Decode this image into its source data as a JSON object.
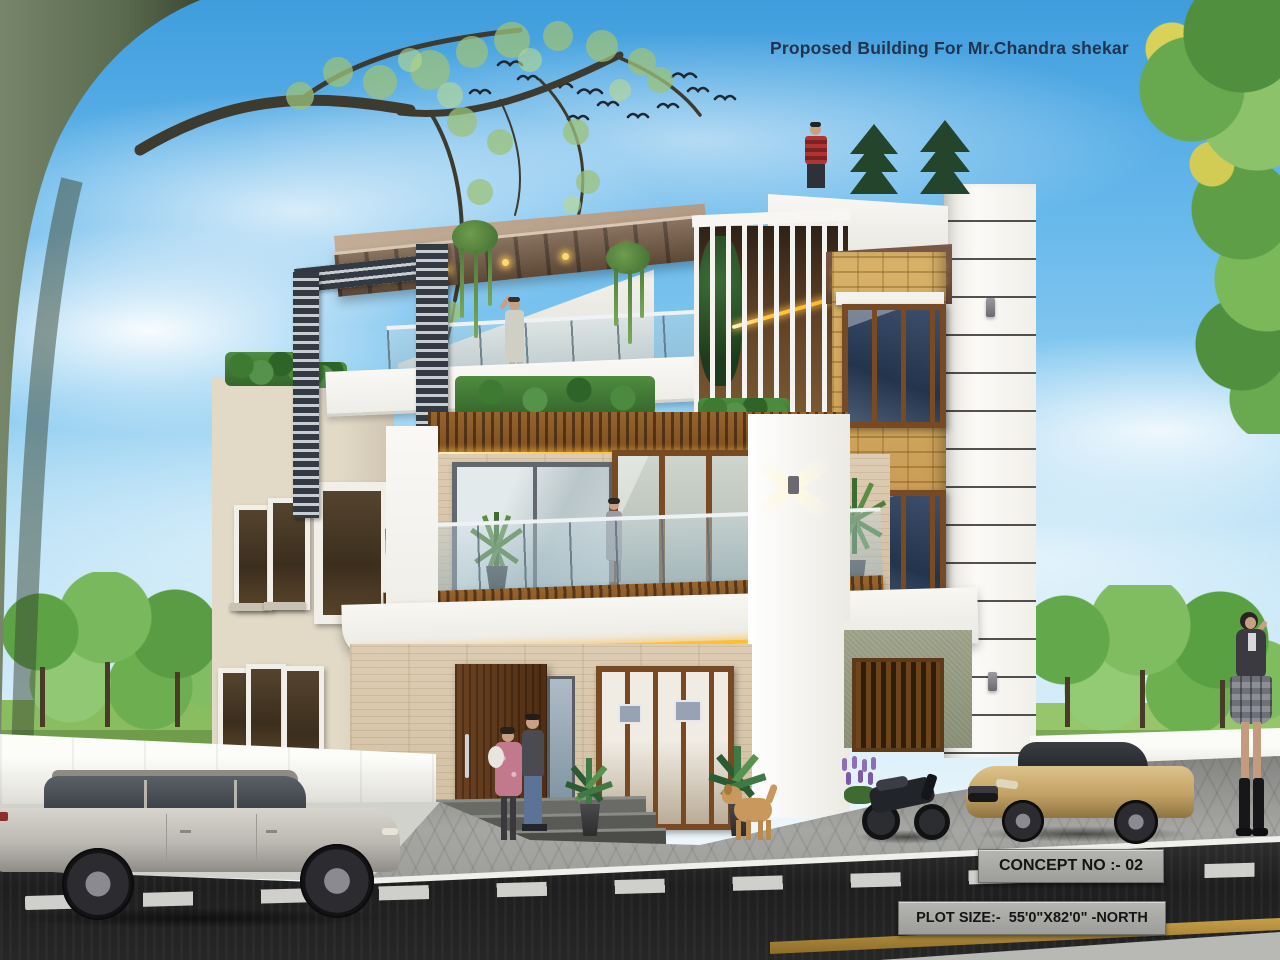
{
  "annotations": {
    "title": "Proposed Building For Mr.Chandra shekar",
    "concept_no": "CONCEPT NO :- 02",
    "plot_size": "PLOT SIZE:-  55'0\"X82'0\" -NORTH"
  },
  "palette": {
    "sky_top": "#3f9ddd",
    "sky_horizon": "#edf6fb",
    "wall_white": "#f6f5f1",
    "wall_beige": "#ddd3c0",
    "travertine": "#d9c8ae",
    "stone_yellow": "#cfa45f",
    "wood_brown": "#7a4a22",
    "striped_pillar": "#39404a",
    "led_gold": "#ffc23d",
    "road": "#222222",
    "pavement": "#a6a6a3",
    "curb": "#efefeb",
    "grass_green": "#6fae4e",
    "gold_car": "#c3a265",
    "silver_car": "#cfccc6",
    "title_text": "#20334f",
    "info_box_bg": "#a3a3a1",
    "info_text": "#141414"
  },
  "scene": {
    "building": {
      "floors": 3,
      "features": [
        "roof pergola with wood slats",
        "striped pillar",
        "glass balcony with wood slat base",
        "vertical white louvers",
        "yellow stone feature wall",
        "grooved white side tower",
        "travertine ground floor",
        "gold LED strip lighting",
        "green hedge planters",
        "x-beam wall sconce"
      ]
    },
    "people": [
      "man on rooftop in red plaid shirt",
      "woman waving on terrace",
      "woman on first-floor balcony",
      "couple with baby at entrance",
      "woman walking at right"
    ],
    "vehicles": [
      "silver estate car",
      "gold sedan",
      "black sport motorcycle"
    ],
    "animals": [
      "golden dog"
    ],
    "vegetation": [
      "large overhanging tree left",
      "leafy tree right",
      "background trees",
      "rooftop conifers",
      "hanging planters",
      "potted plants",
      "lavender shrubs"
    ],
    "environment": [
      "blue sky with clouds",
      "flock of birds",
      "asphalt road with dashed centre line",
      "paved sidewalk with white curb",
      "white compound wall"
    ]
  }
}
